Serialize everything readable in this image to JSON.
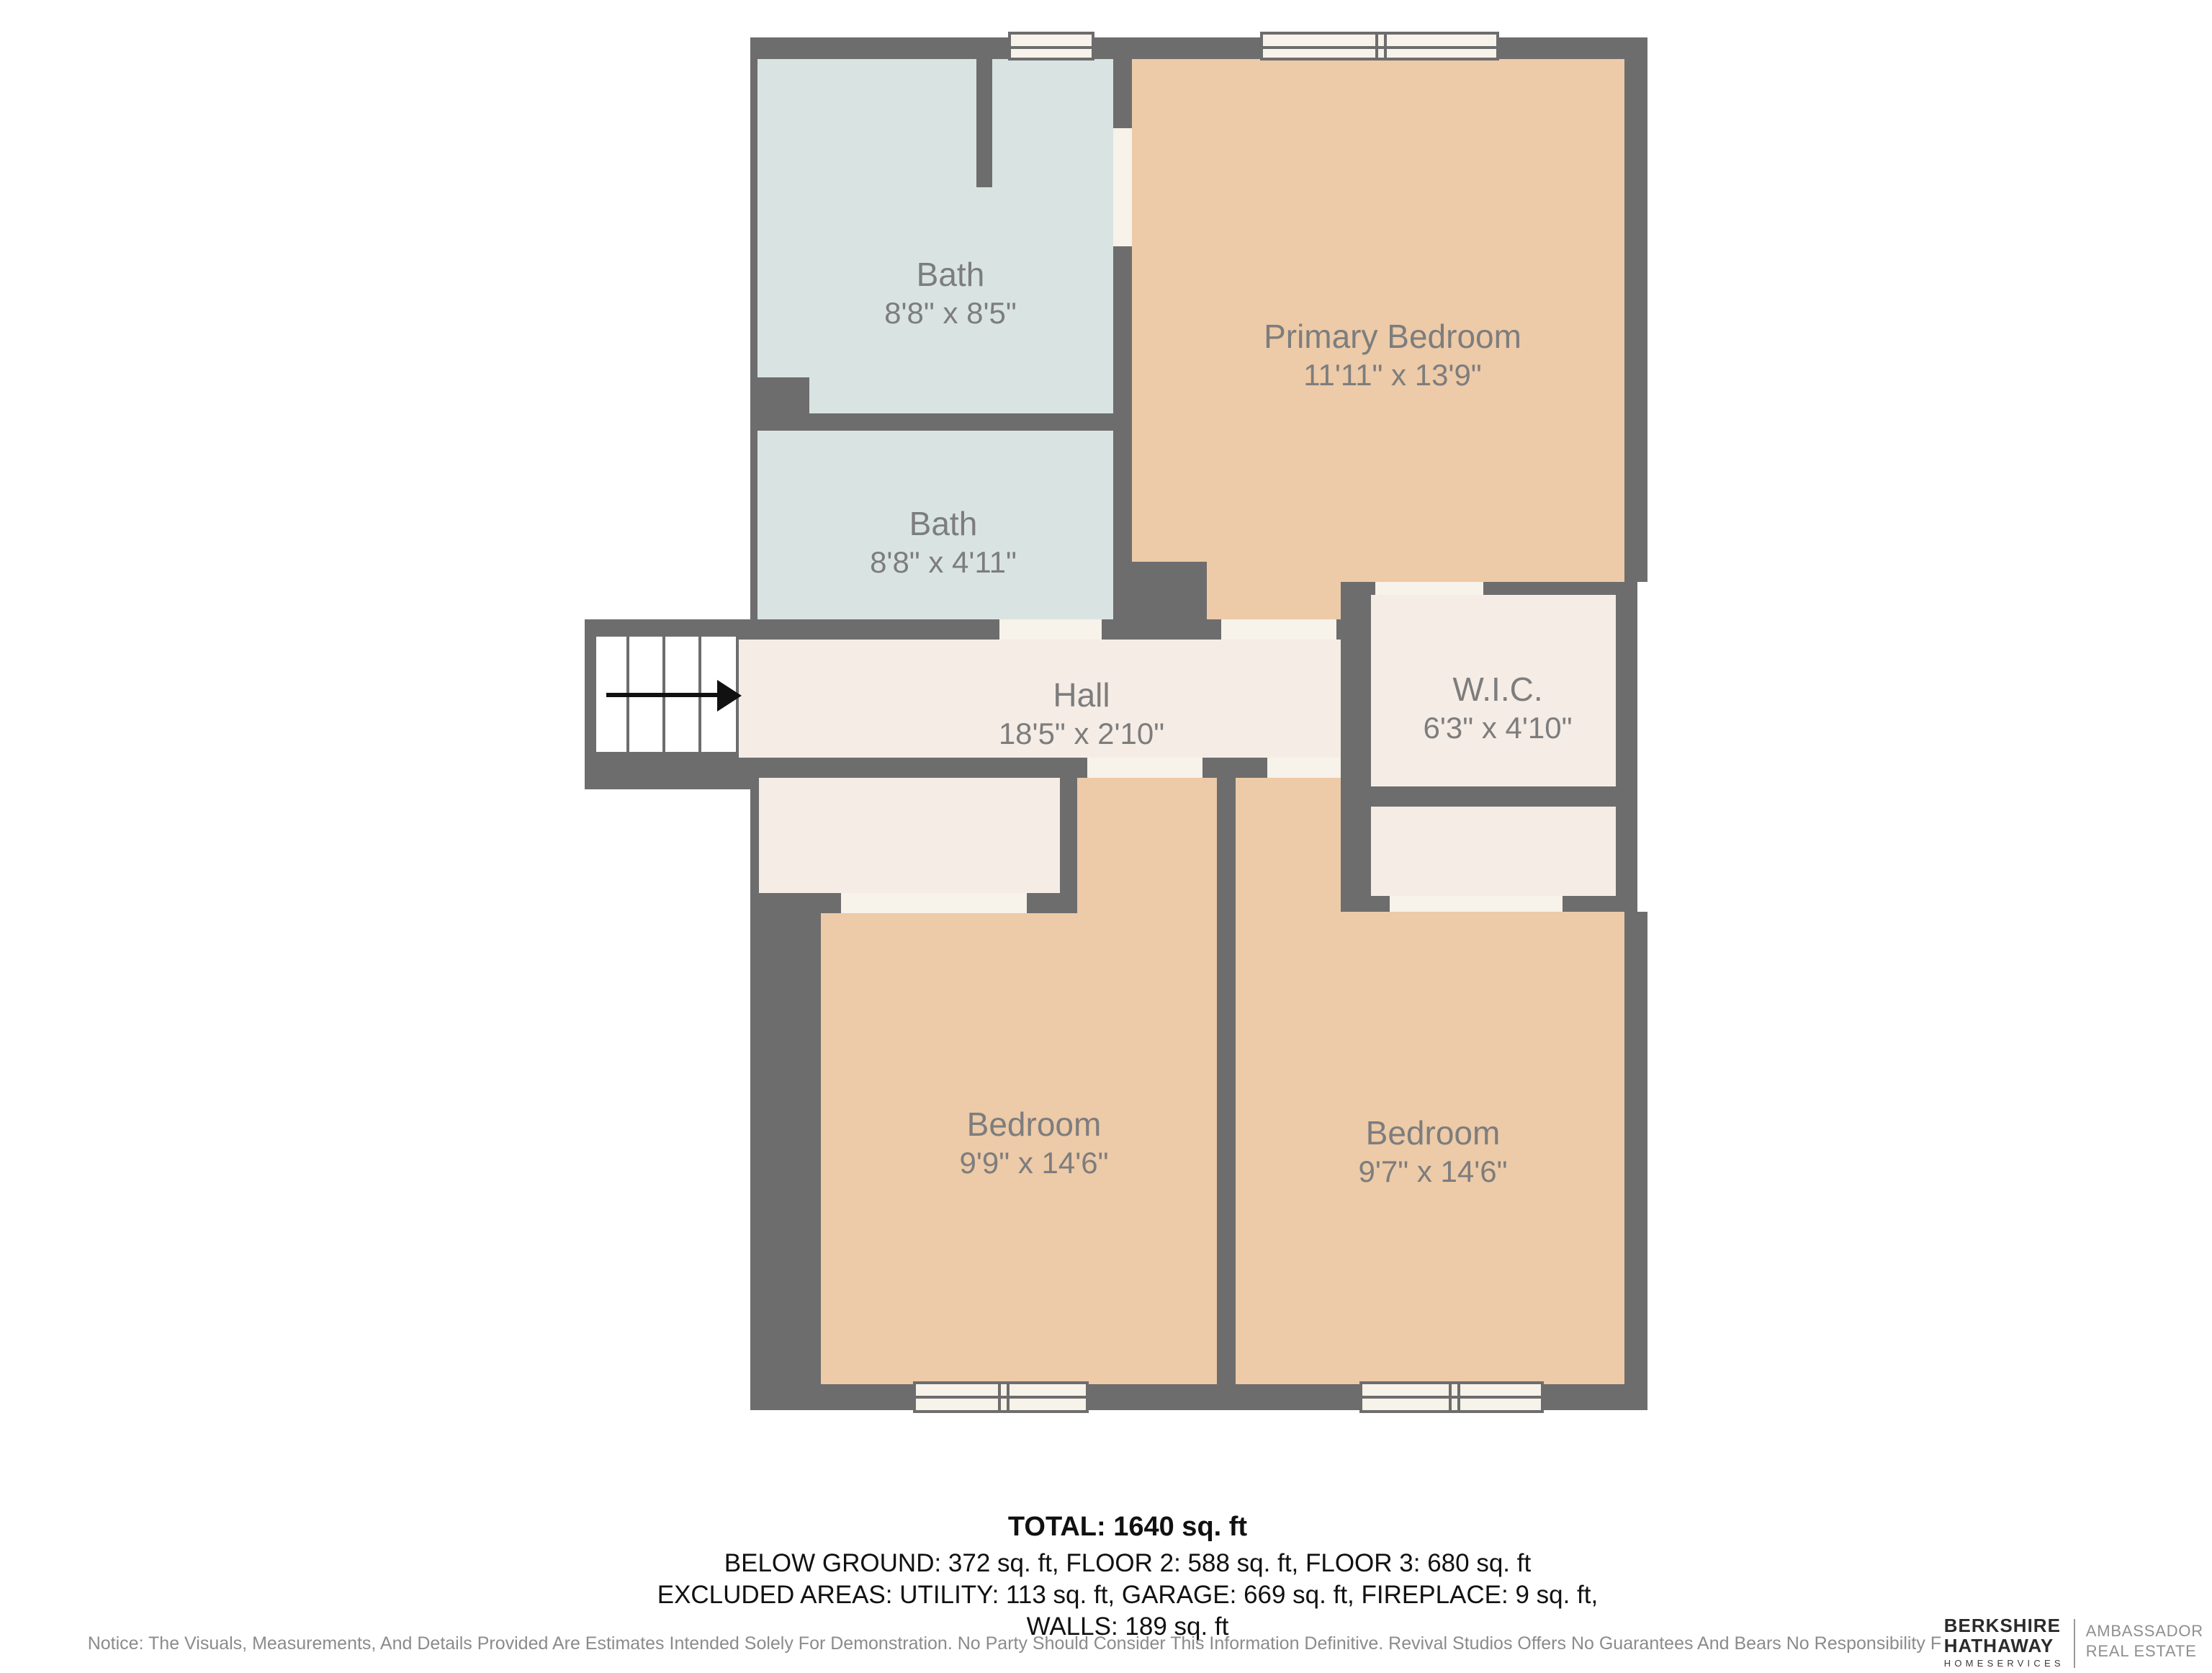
{
  "plan": {
    "colors": {
      "wall": "#6d6d6d",
      "bath": "#d9e4e2",
      "bedroom": "#edcaa8",
      "hall_closet": "#f5ece6",
      "opening": "#f7f2ea",
      "label_text": "#7d7d7d",
      "arrow": "#111111"
    },
    "rooms": {
      "bath_top": {
        "name": "Bath",
        "dims": "8'8\" x 8'5\""
      },
      "bath_mid": {
        "name": "Bath",
        "dims": "8'8\" x 4'11\""
      },
      "primary_bedroom": {
        "name": "Primary Bedroom",
        "dims": "11'11\" x 13'9\""
      },
      "hall": {
        "name": "Hall",
        "dims": "18'5\" x 2'10\""
      },
      "wic": {
        "name": "W.I.C.",
        "dims": "6'3\" x 4'10\""
      },
      "bedroom_left": {
        "name": "Bedroom",
        "dims": "9'9\" x 14'6\""
      },
      "bedroom_right": {
        "name": "Bedroom",
        "dims": "9'7\" x 14'6\""
      }
    },
    "stairs_arrow": "right"
  },
  "summary": {
    "total": "TOTAL: 1640 sq. ft",
    "line2": "BELOW GROUND: 372 sq. ft, FLOOR 2: 588 sq. ft, FLOOR 3: 680 sq. ft",
    "line3": "EXCLUDED AREAS: UTILITY: 113 sq. ft, GARAGE: 669 sq. ft, FIREPLACE: 9 sq. ft,",
    "line4": "WALLS: 189 sq. ft"
  },
  "notice": "Notice: The Visuals, Measurements, And Details Provided Are Estimates Intended Solely For Demonstration. No Party Should Consider This Information Definitive. Revival Studios Offers No Guarantees And Bears No Responsibility For The Use Of This Material",
  "brand": {
    "name_line1": "BERKSHIRE",
    "name_line2": "HATHAWAY",
    "name_line3": "HOMESERVICES",
    "division_line1": "AMBASSADOR",
    "division_line2": "REAL ESTATE"
  }
}
